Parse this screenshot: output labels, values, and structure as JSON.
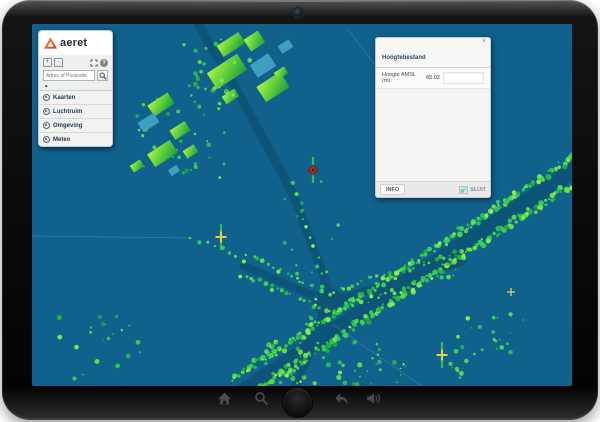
{
  "sidebar": {
    "logo_text": "aeret",
    "search_placeholder": "Adres of Postcode",
    "items": [
      {
        "label": "Kaarten"
      },
      {
        "label": "Luchtruim"
      },
      {
        "label": "Omgeving"
      },
      {
        "label": "Meteo"
      }
    ]
  },
  "icons": {
    "zoom_in": "+",
    "zoom_out": "-",
    "help": "?",
    "collapse": "▲",
    "close": "×"
  },
  "popup": {
    "title": "Hoogtebestand",
    "field_label": "Hoogte AMSL (m):",
    "field_value": "65.02",
    "footer_tab": "INFO",
    "close_button": "SLUIT"
  },
  "colors": {
    "map_bg": "#10618c",
    "road": "#0c5478",
    "tree_green": "#3fd64b",
    "building_green": "#6fe82f",
    "building_teal": "#3f9fc0",
    "logo_orange": "#f7941e",
    "logo_red": "#d6341f"
  },
  "map": {
    "markers": [
      {
        "name": "obstacle-marker",
        "shape": "diamond",
        "color": "#bb2d16",
        "x": 281,
        "y": 146,
        "streak": true
      },
      {
        "name": "waypoint-marker",
        "shape": "cross",
        "color": "#e6cf3e",
        "x": 189,
        "y": 213,
        "streak": true
      },
      {
        "name": "waypoint-marker",
        "shape": "cross",
        "color": "#e6cf3e",
        "x": 410,
        "y": 331,
        "streak": true
      },
      {
        "name": "small-cross-marker",
        "shape": "cross",
        "color": "#cdbd7c",
        "x": 479,
        "y": 268,
        "streak": false,
        "small": true
      }
    ]
  }
}
